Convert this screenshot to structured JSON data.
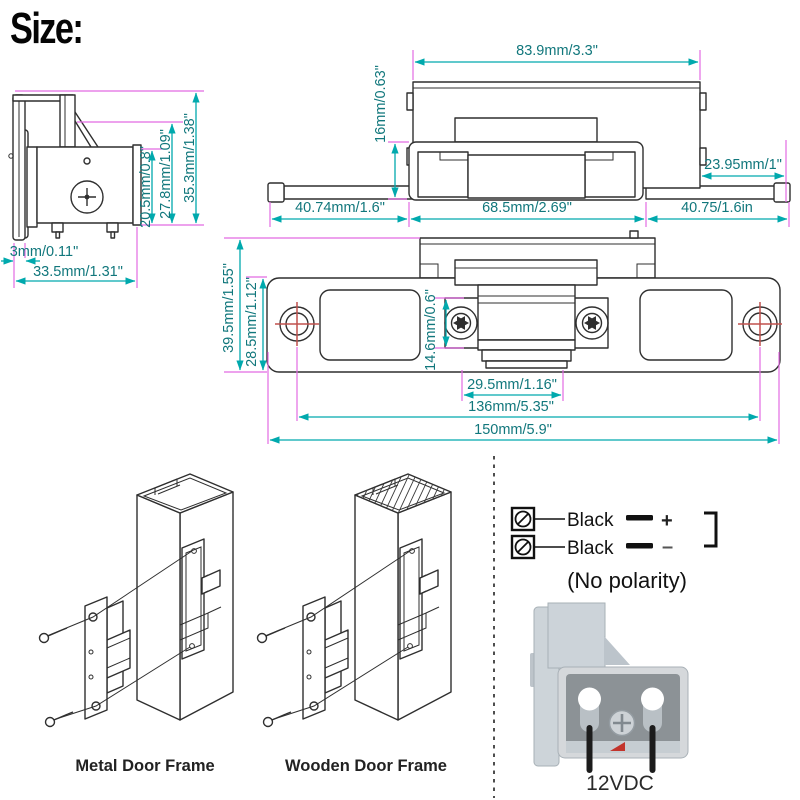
{
  "title": "Size:",
  "colors": {
    "dimension_line": "#00a9ad",
    "extension_line": "#e26be2",
    "crosshair_red": "#c0504d",
    "drawing_line": "#2f2f2f",
    "render_body_gray": "#d2d7db",
    "render_panel_gray": "#8c9296",
    "wire_black": "#1c1c1c"
  },
  "side_view": {
    "dim_body_height": "20.5mm/0.8\"",
    "dim_mid_height": "27.8mm/1.09\"",
    "dim_total_height": "35.3mm/1.38\"",
    "dim_plate_thickness": "3mm/0.11\"",
    "dim_total_depth": "33.5mm/1.31\""
  },
  "top_view": {
    "dim_body_width": "83.9mm/3.3\"",
    "dim_body_depth": "16mm/0.63\"",
    "dim_right_offset": "23.95mm/1\"",
    "dim_left_wing": "40.74mm/1.6\"",
    "dim_center": "68.5mm/2.69\"",
    "dim_right_wing": "40.75/1.6in"
  },
  "front_view": {
    "dim_plate_height": "39.5mm/1.55\"",
    "dim_inner_height": "28.5mm/1.12\"",
    "dim_keeper_height": "14.6mm/0.6\"",
    "dim_keeper_width": "29.5mm/1.16\"",
    "dim_hole_spacing": "136mm/5.35\"",
    "dim_total_length": "150mm/5.9\""
  },
  "installation": {
    "metal_label": "Metal Door Frame",
    "wooden_label": "Wooden Door Frame"
  },
  "wiring": {
    "terminal1_label": "Black",
    "terminal2_label": "Black",
    "plus_sign": "+",
    "minus_sign": "–",
    "polarity_note": "(No polarity)",
    "voltage_label": "12VDC"
  }
}
